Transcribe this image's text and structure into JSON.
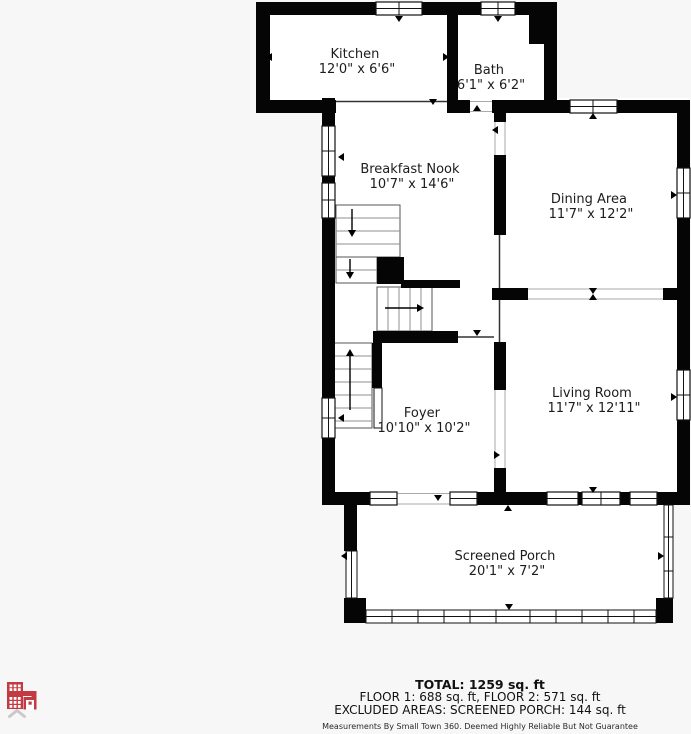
{
  "plan": {
    "rooms": [
      {
        "name": "Kitchen",
        "dims": "12'0\" x 6'6\""
      },
      {
        "name": "Bath",
        "dims": "6'1\" x 6'2\""
      },
      {
        "name": "Breakfast Nook",
        "dims": "10'7\" x 14'6\""
      },
      {
        "name": "Dining Area",
        "dims": "11'7\" x 12'2\""
      },
      {
        "name": "Living Room",
        "dims": "11'7\" x 12'11\""
      },
      {
        "name": "Foyer",
        "dims": "10'10\" x 10'2\""
      },
      {
        "name": "Screened Porch",
        "dims": "20'1\" x 7'2\""
      }
    ],
    "summary": {
      "total": "TOTAL: 1259 sq. ft",
      "floors": "FLOOR 1: 688 sq. ft, FLOOR 2: 571 sq. ft",
      "excluded": "EXCLUDED AREAS: SCREENED PORCH: 144 sq. ft"
    },
    "disclaimer": "Measurements By Small Town 360. Deemed Highly Reliable But Not Guarantee",
    "logo": {
      "icon": "building-icon",
      "chevron": "chevron-up-icon",
      "color": "#c23b42"
    },
    "colors": {
      "wall": "#050505",
      "floor": "#ffffff",
      "background": "#f7f7f7"
    }
  }
}
